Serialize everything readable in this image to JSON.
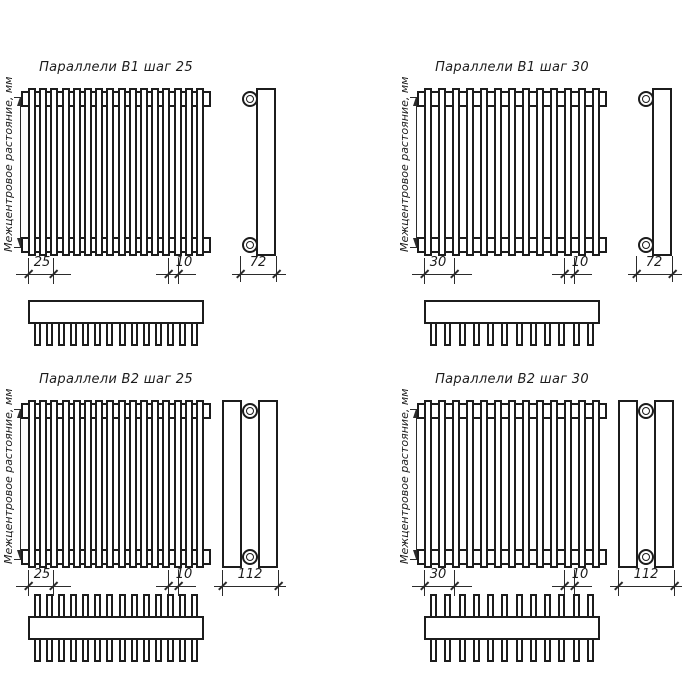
{
  "page": {
    "background_color": "#ffffff",
    "line_color": "#1c1c1c"
  },
  "quadrants": [
    {
      "id": "b1-step-25",
      "title": "Параллели В1 шаг 25",
      "left_dim_label": "Межцентровое растояние, мм",
      "pitch_dim": "25",
      "pitch_px": 25,
      "tube_dim": "10",
      "depth_dim": "72",
      "tube_count": 16,
      "comb_teeth": 14,
      "comb_rows": "bottom",
      "side_type": "single-row"
    },
    {
      "id": "b1-step-30",
      "title": "Параллели В1 шаг 30",
      "left_dim_label": "Межцентровое растояние, мм",
      "pitch_dim": "30",
      "pitch_px": 30,
      "tube_dim": "10",
      "depth_dim": "72",
      "tube_count": 13,
      "comb_teeth": 12,
      "comb_rows": "bottom",
      "side_type": "single-row"
    },
    {
      "id": "b2-step-25",
      "title": "Параллели В2 шаг 25",
      "left_dim_label": "Межцентровое растояние, мм",
      "pitch_dim": "25",
      "pitch_px": 25,
      "tube_dim": "10",
      "depth_dim": "112",
      "tube_count": 16,
      "comb_teeth": 14,
      "comb_rows": "both",
      "side_type": "double-row"
    },
    {
      "id": "b2-step-30",
      "title": "Параллели В2 шаг 30",
      "left_dim_label": "Межцентровое растояние, мм",
      "pitch_dim": "30",
      "pitch_px": 30,
      "tube_dim": "10",
      "depth_dim": "112",
      "tube_count": 13,
      "comb_teeth": 12,
      "comb_rows": "both",
      "side_type": "double-row"
    }
  ]
}
